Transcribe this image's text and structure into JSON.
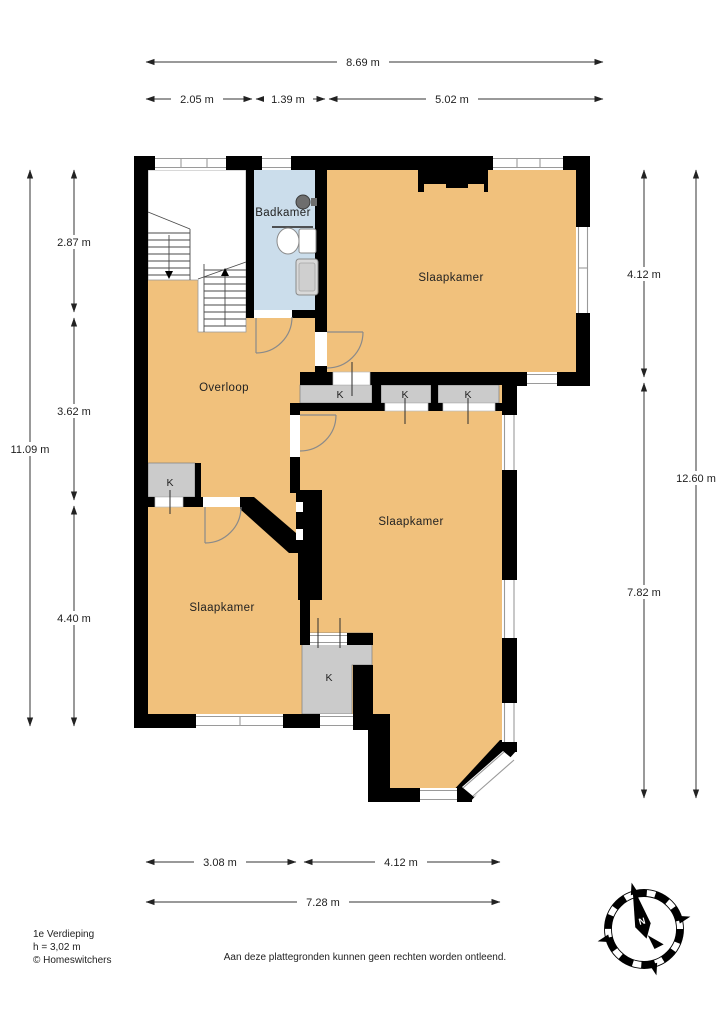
{
  "plan": {
    "rooms": {
      "bathroom": "Badkamer",
      "bedroom_top": "Slaapkamer",
      "bedroom_middle": "Slaapkamer",
      "bedroom_bottom": "Slaapkamer",
      "landing": "Overloop"
    },
    "closets": {
      "k1": "K",
      "k2": "K",
      "k3": "K",
      "k4": "K",
      "k5": "K"
    },
    "compass_north": "N"
  },
  "dimensions": {
    "top_total": "8.69 m",
    "top_segments": [
      "2.05 m",
      "1.39 m",
      "5.02 m"
    ],
    "left_total": "11.09 m",
    "left_segments": [
      "2.87 m",
      "3.62 m",
      "4.40 m"
    ],
    "right_total": "12.60 m",
    "right_segments": [
      "4.12 m",
      "7.82 m"
    ],
    "bottom_total": "7.28 m",
    "bottom_segments": [
      "3.08 m",
      "4.12 m"
    ]
  },
  "footer": {
    "floor_name": "1e Verdieping",
    "ceiling_height": "h = 3,02 m",
    "copyright": "© Homeswitchers",
    "disclaimer": "Aan deze plattegronden kunnen geen rechten worden ontleend."
  },
  "colors": {
    "room_fill": "#F1C17C",
    "bathroom_fill": "#CBDDEB",
    "closet_fill": "#CBCBCB",
    "wall": "#000000"
  }
}
